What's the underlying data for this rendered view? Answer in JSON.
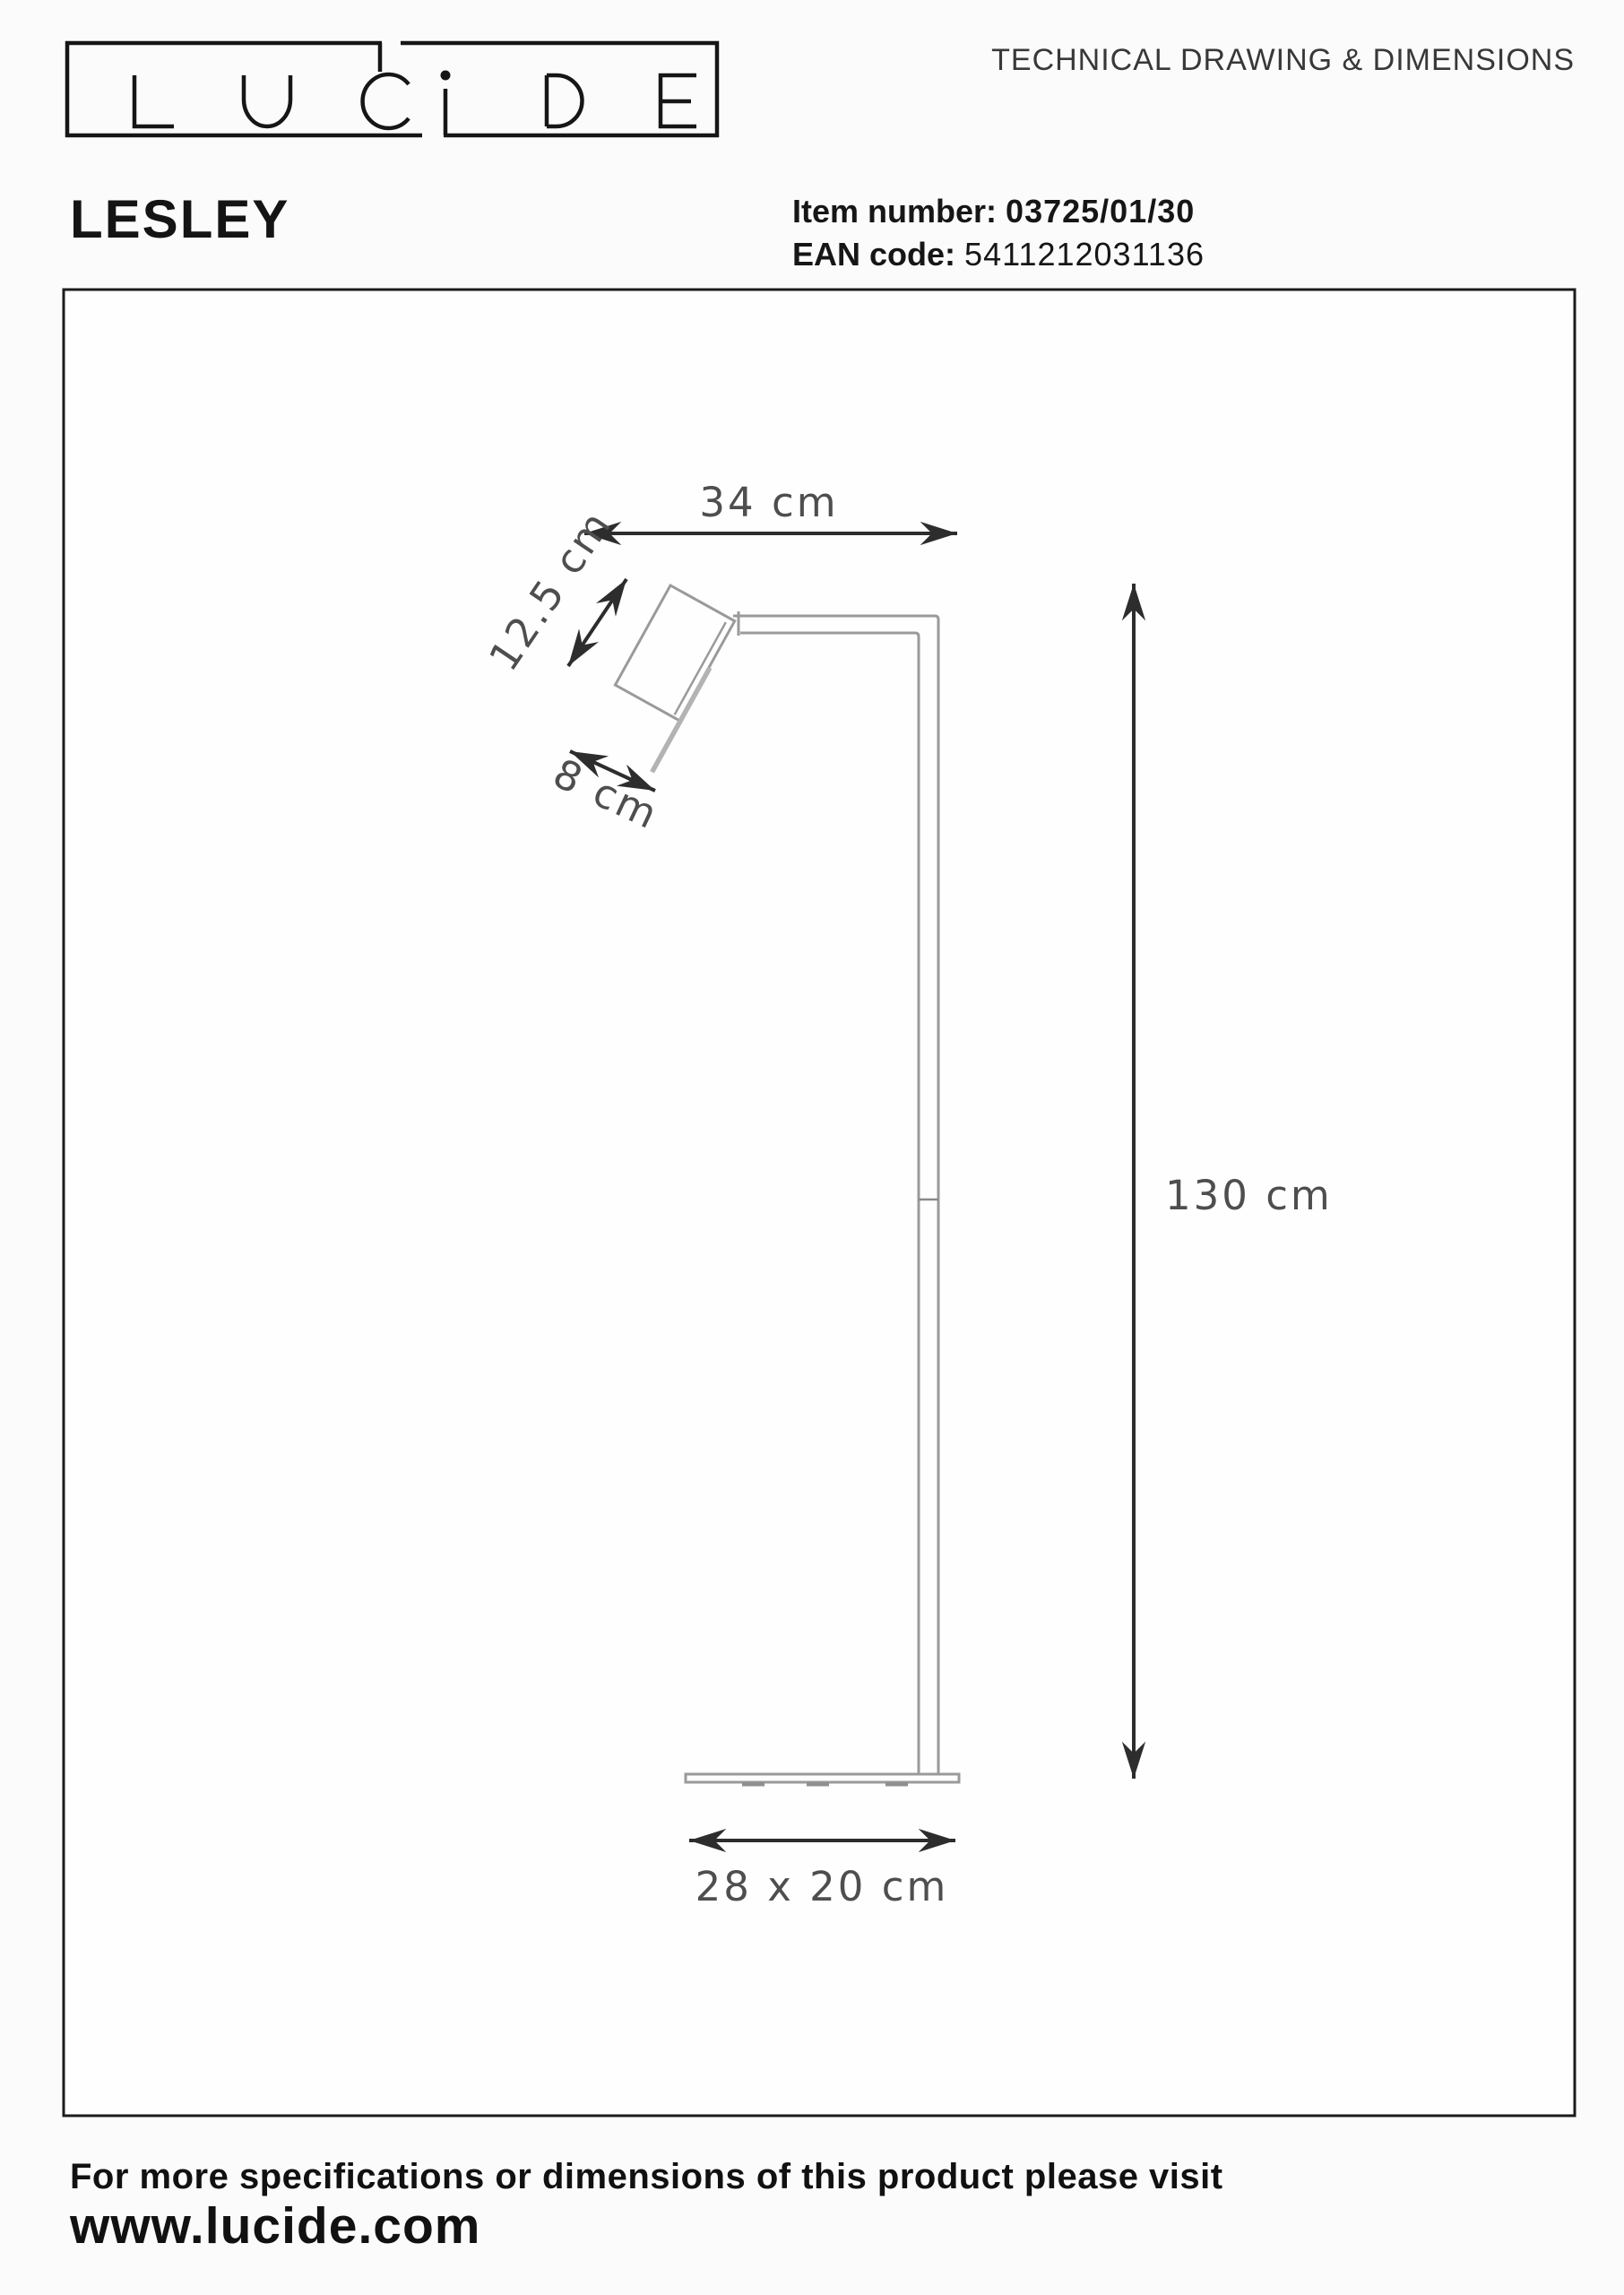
{
  "header": {
    "brand": "LUCIDE",
    "logo_letters": [
      "L",
      "U",
      "C",
      "i",
      "D",
      "E"
    ],
    "doc_title": "TECHNICAL DRAWING & DIMENSIONS",
    "product_name": "LESLEY",
    "item_number_label": "Item number:",
    "item_number_value": "03725/01/30",
    "ean_label": "EAN code:",
    "ean_value": "5411212031136"
  },
  "drawing": {
    "dim_arm_length": "34 cm",
    "dim_head_height": "12.5 cm",
    "dim_head_width": "8 cm",
    "dim_total_height": "130 cm",
    "dim_base_size": "28 x 20 cm"
  },
  "footer": {
    "note": "For more specifications or dimensions of this product please visit",
    "website": "www.lucide.com"
  },
  "colors": {
    "ink": "#161616",
    "frame": "#1c1c1c",
    "dim_line": "#2d2d2d",
    "dim_text": "#4e4e4e",
    "lamp_line": "#9a9a9a"
  }
}
